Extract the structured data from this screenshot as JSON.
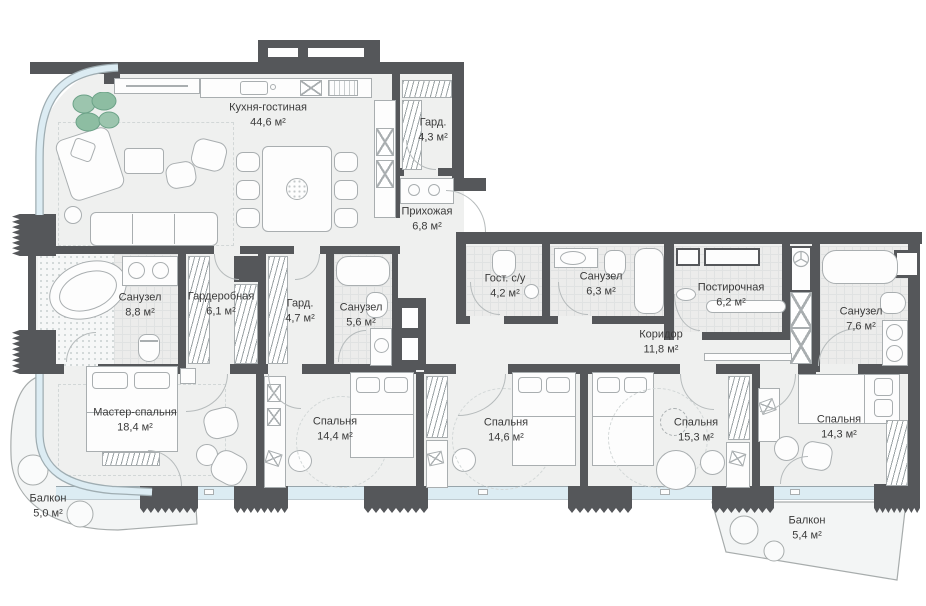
{
  "plan": {
    "title": "Апартаменты — план этажа",
    "rooms": [
      {
        "id": "kitchen-living",
        "name": "Кухня-гостиная",
        "area": "44,6 м²"
      },
      {
        "id": "wardrobe-top",
        "name": "Гард.",
        "area": "4,3 м²"
      },
      {
        "id": "hallway",
        "name": "Прихожая",
        "area": "6,8 м²"
      },
      {
        "id": "bathroom-master",
        "name": "Санузел",
        "area": "8,8 м²"
      },
      {
        "id": "dressing-room",
        "name": "Гардеробная",
        "area": "6,1 м²"
      },
      {
        "id": "wardrobe-small",
        "name": "Гард.",
        "area": "4,7 м²"
      },
      {
        "id": "bathroom-2",
        "name": "Санузел",
        "area": "5,6 м²"
      },
      {
        "id": "guest-wc",
        "name": "Гост. с/у",
        "area": "4,2 м²"
      },
      {
        "id": "bathroom-3",
        "name": "Санузел",
        "area": "6,3 м²"
      },
      {
        "id": "laundry",
        "name": "Постирочная",
        "area": "6,2 м²"
      },
      {
        "id": "bathroom-4",
        "name": "Санузел",
        "area": "7,6 м²"
      },
      {
        "id": "corridor",
        "name": "Коридор",
        "area": "11,8 м²"
      },
      {
        "id": "master-bedroom",
        "name": "Мастер-спальня",
        "area": "18,4 м²"
      },
      {
        "id": "bedroom-2",
        "name": "Спальня",
        "area": "14,4 м²"
      },
      {
        "id": "bedroom-3",
        "name": "Спальня",
        "area": "14,6 м²"
      },
      {
        "id": "bedroom-4",
        "name": "Спальня",
        "area": "15,3 м²"
      },
      {
        "id": "bedroom-5",
        "name": "Спальня",
        "area": "14,3 м²"
      },
      {
        "id": "balcony-left",
        "name": "Балкон",
        "area": "5,0 м²"
      },
      {
        "id": "balcony-right",
        "name": "Балкон",
        "area": "5,4 м²"
      }
    ],
    "colors": {
      "wall": "#55575a",
      "floor": "#eff0ef",
      "glazing": "#dcecf3",
      "furniture_outline": "#a9aeb0",
      "plant": "#9cc5ae",
      "text": "#3a3a3a"
    }
  }
}
